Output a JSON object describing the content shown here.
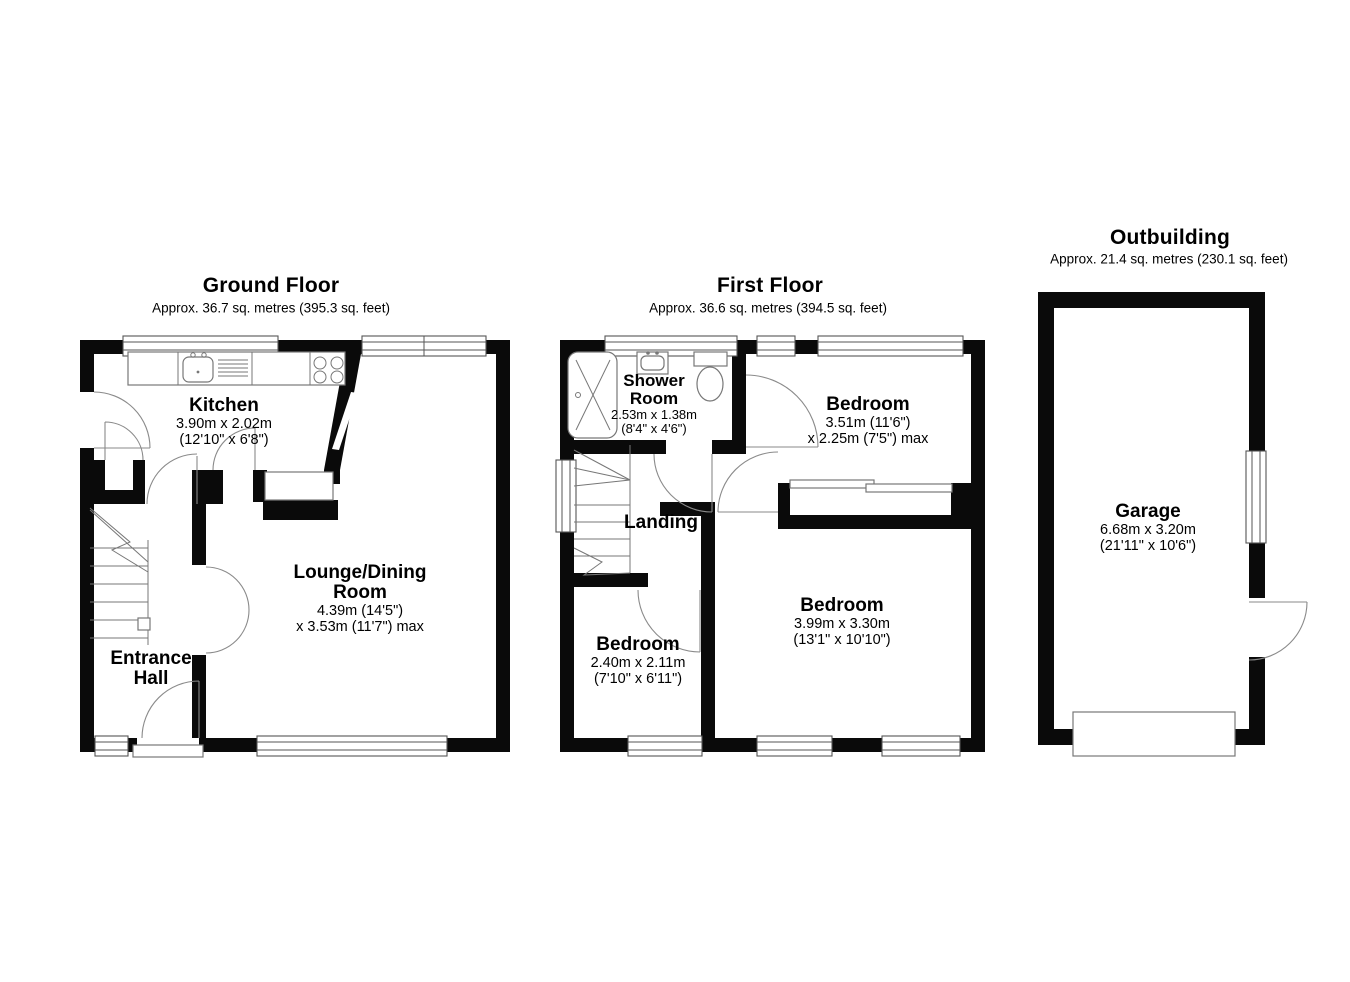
{
  "page": {
    "background": "#ffffff",
    "wall_color": "#0a0a0a",
    "detail_color": "#777777"
  },
  "floors": {
    "ground": {
      "title": "Ground Floor",
      "subtitle": "Approx. 36.7 sq. metres (395.3 sq. feet)",
      "rooms": {
        "kitchen": {
          "name": "Kitchen",
          "dims": "3.90m x 2.02m\n(12'10\" x 6'8\")"
        },
        "lounge_dining": {
          "name": "Lounge/Dining\nRoom",
          "dims": "4.39m (14'5\")\nx 3.53m (11'7\") max"
        },
        "entrance_hall": {
          "name": "Entrance\nHall"
        }
      }
    },
    "first": {
      "title": "First Floor",
      "subtitle": "Approx. 36.6 sq. metres (394.5 sq. feet)",
      "rooms": {
        "shower_room": {
          "name": "Shower\nRoom",
          "dims": "2.53m x 1.38m\n(8'4\" x 4'6\")"
        },
        "bedroom_top": {
          "name": "Bedroom",
          "dims": "3.51m (11'6\")\nx 2.25m (7'5\") max"
        },
        "landing": {
          "name": "Landing"
        },
        "bedroom_small": {
          "name": "Bedroom",
          "dims": "2.40m x 2.11m\n(7'10\" x 6'11\")"
        },
        "bedroom_large": {
          "name": "Bedroom",
          "dims": "3.99m x 3.30m\n(13'1\" x 10'10\")"
        }
      }
    },
    "outbuilding": {
      "title": "Outbuilding",
      "subtitle": "Approx. 21.4 sq. metres (230.1 sq. feet)",
      "rooms": {
        "garage": {
          "name": "Garage",
          "dims": "6.68m x 3.20m\n(21'11\" x 10'6\")"
        }
      }
    }
  }
}
